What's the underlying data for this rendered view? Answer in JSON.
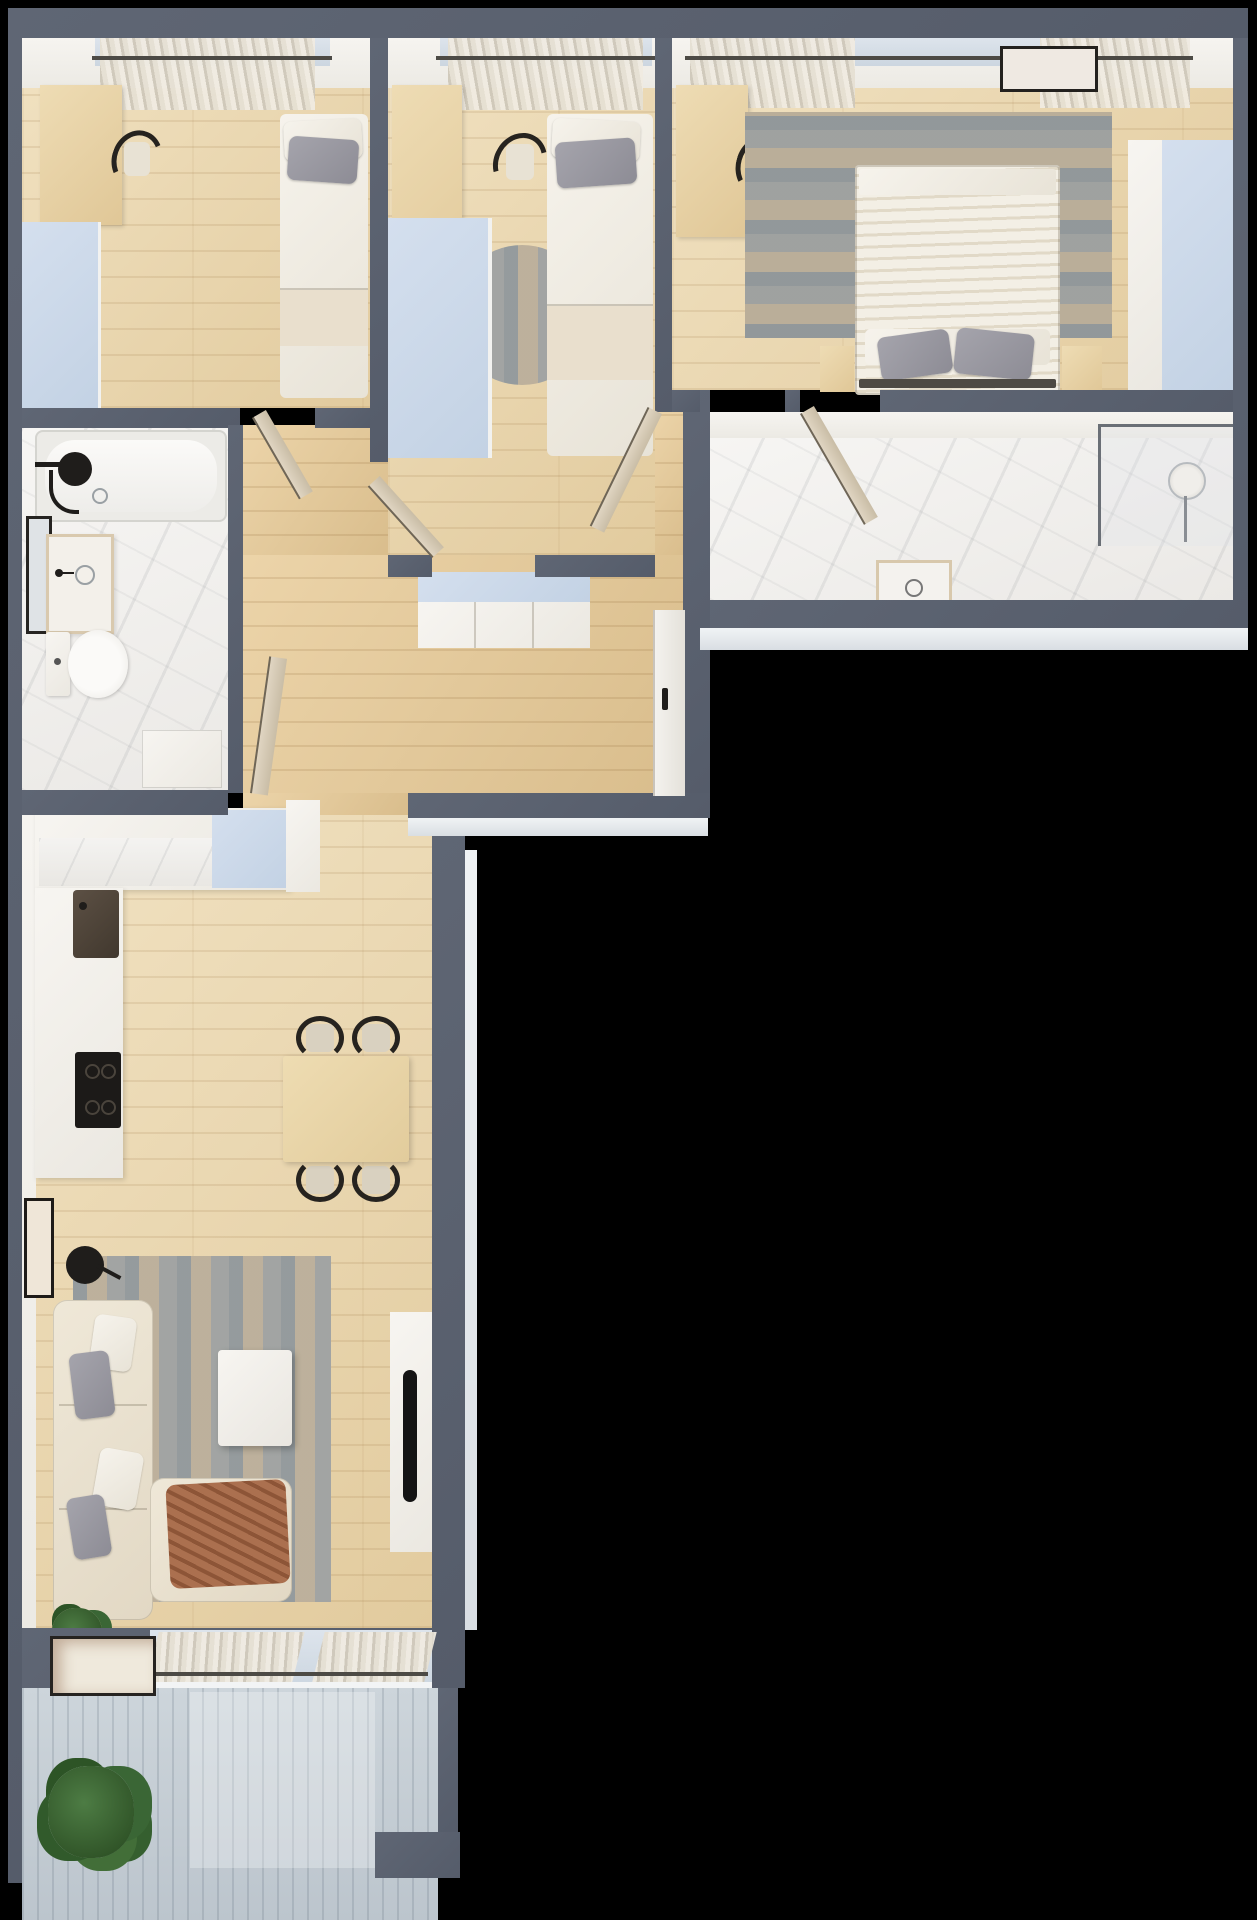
{
  "scene": {
    "kind": "3d-rendered-apartment-floor-plan-top-view",
    "background_color": "#000000",
    "visible_text": "none"
  },
  "palette": {
    "wall": "#5a6170",
    "exterior_trim": "#e9edf0",
    "wood_floor": "#e8d3a9",
    "hall_floor": "#e0c497",
    "marble_floor": "#f3f2f0",
    "white_furniture": "#f4f2ee",
    "light_blue_furniture": "#cdd9e9",
    "bed_linen": "#f2efe8",
    "beige_blanket": "#e9dfcd",
    "gray_pillow": "#9b9aa2",
    "rug_blue_gray": "#8fa0ae",
    "rug_tan": "#c8b69c",
    "dining_table_wood": "#ead7ad",
    "chair_black": "#26231f",
    "sofa_cream": "#ece4d3",
    "throw_brown": "#a4684a",
    "plant_green": "#3f6d3d",
    "balcony_deck": "#c9d2d9",
    "tv_black": "#141414"
  },
  "rooms": [
    {
      "name": "bedroom-1",
      "position": "top-left",
      "furniture": [
        "window-with-curtains",
        "desk",
        "desk-chair",
        "light-blue-wardrobe",
        "single-bed",
        "gray-pillow"
      ]
    },
    {
      "name": "bedroom-2",
      "position": "top-middle",
      "furniture": [
        "window-with-curtains",
        "desk",
        "desk-chair",
        "light-blue-wardrobe",
        "round-rug",
        "single-bed",
        "gray-pillow"
      ]
    },
    {
      "name": "master-bedroom",
      "position": "top-right",
      "furniture": [
        "window-with-curtains",
        "wall-art",
        "desk",
        "desk-chair",
        "area-rug",
        "double-bed",
        "gray-pillows",
        "nightstand-left",
        "nightstand-right",
        "built-in-wardrobe"
      ]
    },
    {
      "name": "bathroom-1",
      "position": "middle-left",
      "furniture": [
        "bathtub",
        "black-shower-fixture",
        "wall-mirror",
        "sink-vanity",
        "toilet",
        "washer-cabinet"
      ]
    },
    {
      "name": "bathroom-2",
      "position": "middle-right",
      "furniture": [
        "walk-in-shower-glass",
        "shower-head",
        "sink-vanity"
      ]
    },
    {
      "name": "hallway",
      "position": "center",
      "furniture": [
        "sideboard-light-blue-top",
        "entrance-door",
        "open-interior-doors"
      ]
    },
    {
      "name": "living-room-kitchen",
      "position": "bottom-left",
      "furniture": [
        "l-shaped-kitchen-counter",
        "light-blue-counter-block",
        "kitchen-sink",
        "black-cooktop",
        "dining-table",
        "dining-chairs-x4",
        "area-rug",
        "corner-sofa",
        "throw-pillows",
        "brown-throw-blanket",
        "coffee-table",
        "black-floor-lamp",
        "wall-art",
        "leaning-art",
        "tv-cabinet",
        "tv",
        "indoor-plant",
        "window-with-curtains"
      ]
    },
    {
      "name": "balcony",
      "position": "bottom",
      "furniture": [
        "wood-decking",
        "potted-plant"
      ]
    }
  ]
}
